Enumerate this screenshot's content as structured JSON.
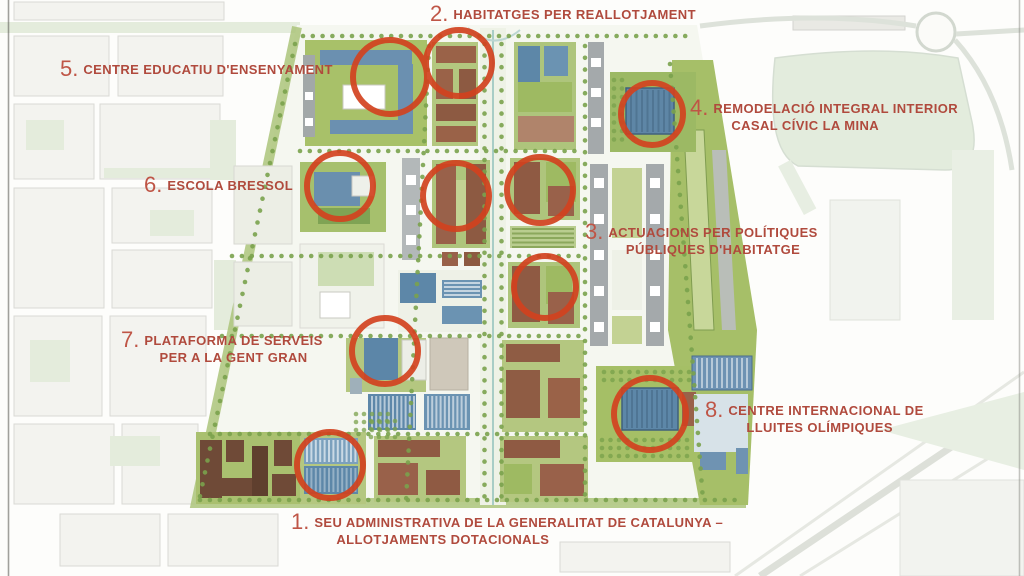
{
  "map": {
    "name": "La Mina district master plan",
    "colors": {
      "annotation_red": "#b04a3d",
      "circle_red": "#d2421f",
      "park_green": "#a6bf68",
      "lawn_green": "#a8c169",
      "pale_green": "#e3ecdd",
      "building_blue": "#5d87a8",
      "building_brown": "#935f47",
      "building_dark_brown": "#6f4a37",
      "building_gray": "#a4a9ab",
      "rambla": "#eef2e6",
      "tree_green": "#7aa24c"
    }
  },
  "annotations": [
    {
      "number": "1.",
      "line1": "SEU ADMINISTRATIVA DE LA GENERALITAT DE CATALUNYA –",
      "line2": "ALLOTJAMENTS DOTACIONALS"
    },
    {
      "number": "2.",
      "line1": "HABITATGES PER REALLOTJAMENT",
      "line2": ""
    },
    {
      "number": "3.",
      "line1": "ACTUACIONS PER POLÍTIQUES",
      "line2": "PÚBLIQUES D'HABITATGE"
    },
    {
      "number": "4.",
      "line1": "REMODELACIÓ INTEGRAL INTERIOR",
      "line2": "CASAL CÍVIC LA MINA"
    },
    {
      "number": "5.",
      "line1": "CENTRE EDUCATIU D'ENSENYAMENT",
      "line2": ""
    },
    {
      "number": "6.",
      "line1": "ESCOLA BRESSOL",
      "line2": ""
    },
    {
      "number": "7.",
      "line1": "PLATAFORMA DE SERVEIS",
      "line2": "PER A LA GENT GRAN",
      "line2_align": "center"
    },
    {
      "number": "8.",
      "line1": "CENTRE INTERNACIONAL DE",
      "line2": "LLUITES OLÍMPIQUES"
    }
  ]
}
